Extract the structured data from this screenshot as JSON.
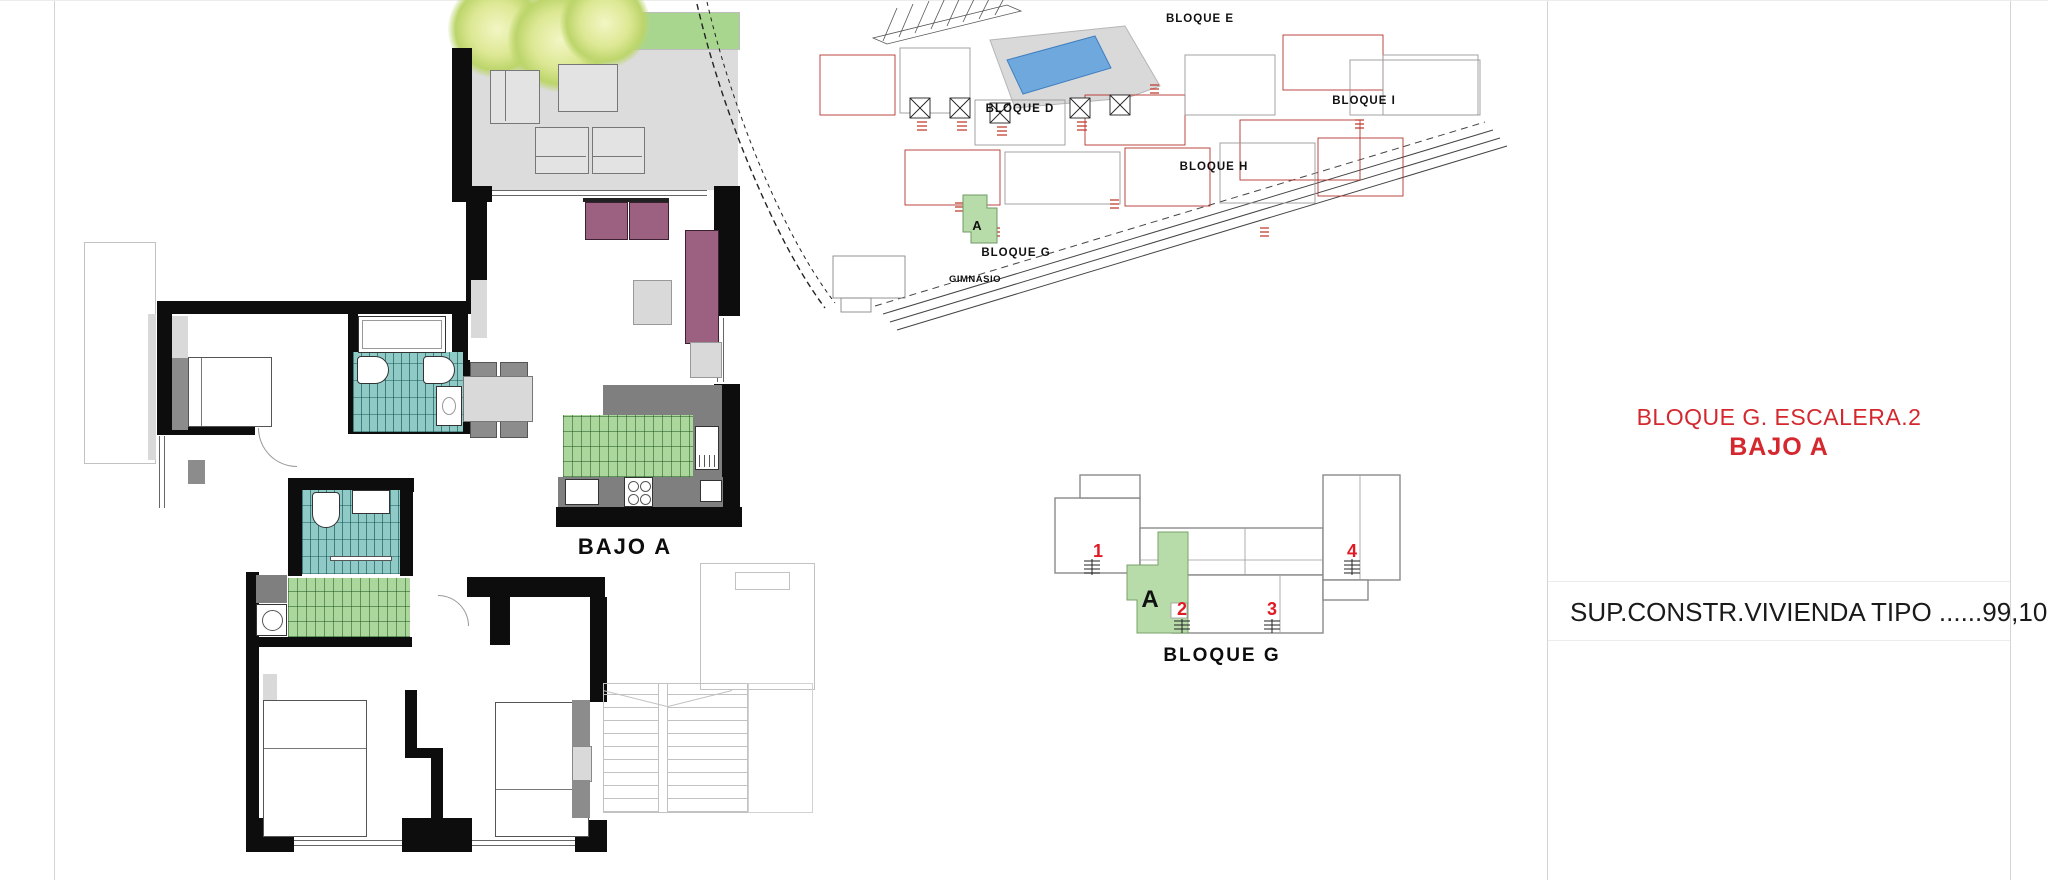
{
  "floor_plan": {
    "label": "BAJO A"
  },
  "site_plan": {
    "bloque_d": "BLOQUE D",
    "bloque_e": "BLOQUE E",
    "bloque_g": "BLOQUE G",
    "bloque_h": "BLOQUE H",
    "bloque_i": "BLOQUE I",
    "gimnasio": "GIMNASIO",
    "highlighted_unit": "A"
  },
  "key_plan": {
    "label": "BLOQUE G",
    "highlighted_unit": "A",
    "stair_numbers": [
      "1",
      "2",
      "3",
      "4"
    ]
  },
  "info_panel": {
    "title_line1": "BLOQUE G. ESCALERA.2",
    "title_line2": "BAJO A",
    "surface_line": "SUP.CONSTR.VIVIENDA TIPO ......99,10m2"
  },
  "colors": {
    "accent_red": "#d4282e",
    "wall_black": "#0d0d0d",
    "tile_teal": "#8fcac7",
    "tile_green": "#abd69c",
    "planter_green": "#a9d68f",
    "terrace_gray": "#dcdcdc",
    "counter_gray": "#7f7f7f",
    "sofa_mauve": "#9c6080",
    "pool_blue": "#6fa8dc",
    "keyplan_green": "#b7dcaa"
  }
}
